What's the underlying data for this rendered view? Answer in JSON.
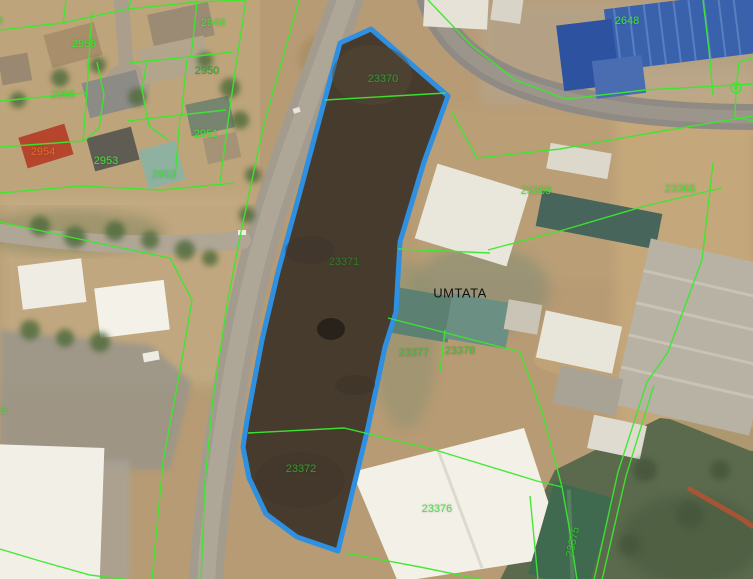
{
  "map": {
    "view": "satellite-cadastral",
    "place": "UMTATA",
    "colors": {
      "cadastral_line": "#3ce82e",
      "label_green": "#3fe531",
      "label_orange": "#e8692d",
      "label_black": "#111111",
      "highlight_outline": "#2f8fe0",
      "highlight_fill": "#463b2d"
    },
    "highlighted_parcel": {
      "outline_color": "#2f8fe0",
      "contains_labels": [
        "23370",
        "23371",
        "23372"
      ]
    },
    "labels": [
      {
        "name": "parcel-label-2949",
        "text": "2949",
        "cx": 213,
        "cy": 23,
        "color": "#3fe531"
      },
      {
        "name": "parcel-label-2956",
        "text": "2956",
        "cx": 84,
        "cy": 44,
        "color": "#3fe531"
      },
      {
        "name": "parcel-label-2950",
        "text": "2950",
        "cx": 207,
        "cy": 71,
        "color": "#2da428"
      },
      {
        "name": "parcel-label-2955",
        "text": "2955",
        "cx": 63,
        "cy": 95,
        "color": "#3fe531"
      },
      {
        "name": "parcel-label-2951",
        "text": "2951",
        "cx": 206,
        "cy": 134,
        "color": "#3fe531"
      },
      {
        "name": "parcel-label-2954",
        "text": "2954",
        "cx": 43,
        "cy": 152,
        "color": "#e8692d"
      },
      {
        "name": "parcel-label-2953",
        "text": "2953",
        "cx": 106,
        "cy": 161,
        "color": "#3fe531"
      },
      {
        "name": "parcel-label-2952",
        "text": "2952",
        "cx": 164,
        "cy": 175,
        "color": "#3fe531"
      },
      {
        "name": "parcel-label-23370",
        "text": "23370",
        "cx": 383,
        "cy": 79,
        "color": "#2f9e2d"
      },
      {
        "name": "parcel-label-2648",
        "text": "2648",
        "cx": 627,
        "cy": 21,
        "color": "#3fe531"
      },
      {
        "name": "parcel-label-23369",
        "text": "23369",
        "cx": 536,
        "cy": 191,
        "color": "#3fe531"
      },
      {
        "name": "parcel-label-23368",
        "text": "23368",
        "cx": 680,
        "cy": 189,
        "color": "#3fe531"
      },
      {
        "name": "parcel-label-23371",
        "text": "23371",
        "cx": 344,
        "cy": 262,
        "color": "#2c7d28"
      },
      {
        "name": "place-label-umtata",
        "text": "UMTATA",
        "cx": 460,
        "cy": 293,
        "color": "#111111",
        "kind": "place"
      },
      {
        "name": "parcel-label-23377",
        "text": "23377",
        "cx": 414,
        "cy": 353,
        "color": "#35c230"
      },
      {
        "name": "parcel-label-23378",
        "text": "23378",
        "cx": 460,
        "cy": 351,
        "color": "#35c230"
      },
      {
        "name": "parcel-label-23372",
        "text": "23372",
        "cx": 301,
        "cy": 469,
        "color": "#2f9e2d"
      },
      {
        "name": "parcel-label-23376",
        "text": "23376",
        "cx": 437,
        "cy": 509,
        "color": "#52d84b"
      },
      {
        "name": "parcel-label-23375",
        "text": "23375",
        "cx": 573,
        "cy": 542,
        "color": "#35c230",
        "rotate": -78
      },
      {
        "name": "parcel-label-partial-left",
        "text": "3",
        "cx": 3,
        "cy": 411,
        "color": "#3fe531"
      },
      {
        "name": "parcel-label-partial-topleft",
        "text": "3",
        "cx": 0,
        "cy": 21,
        "color": "#3fe531"
      }
    ]
  }
}
